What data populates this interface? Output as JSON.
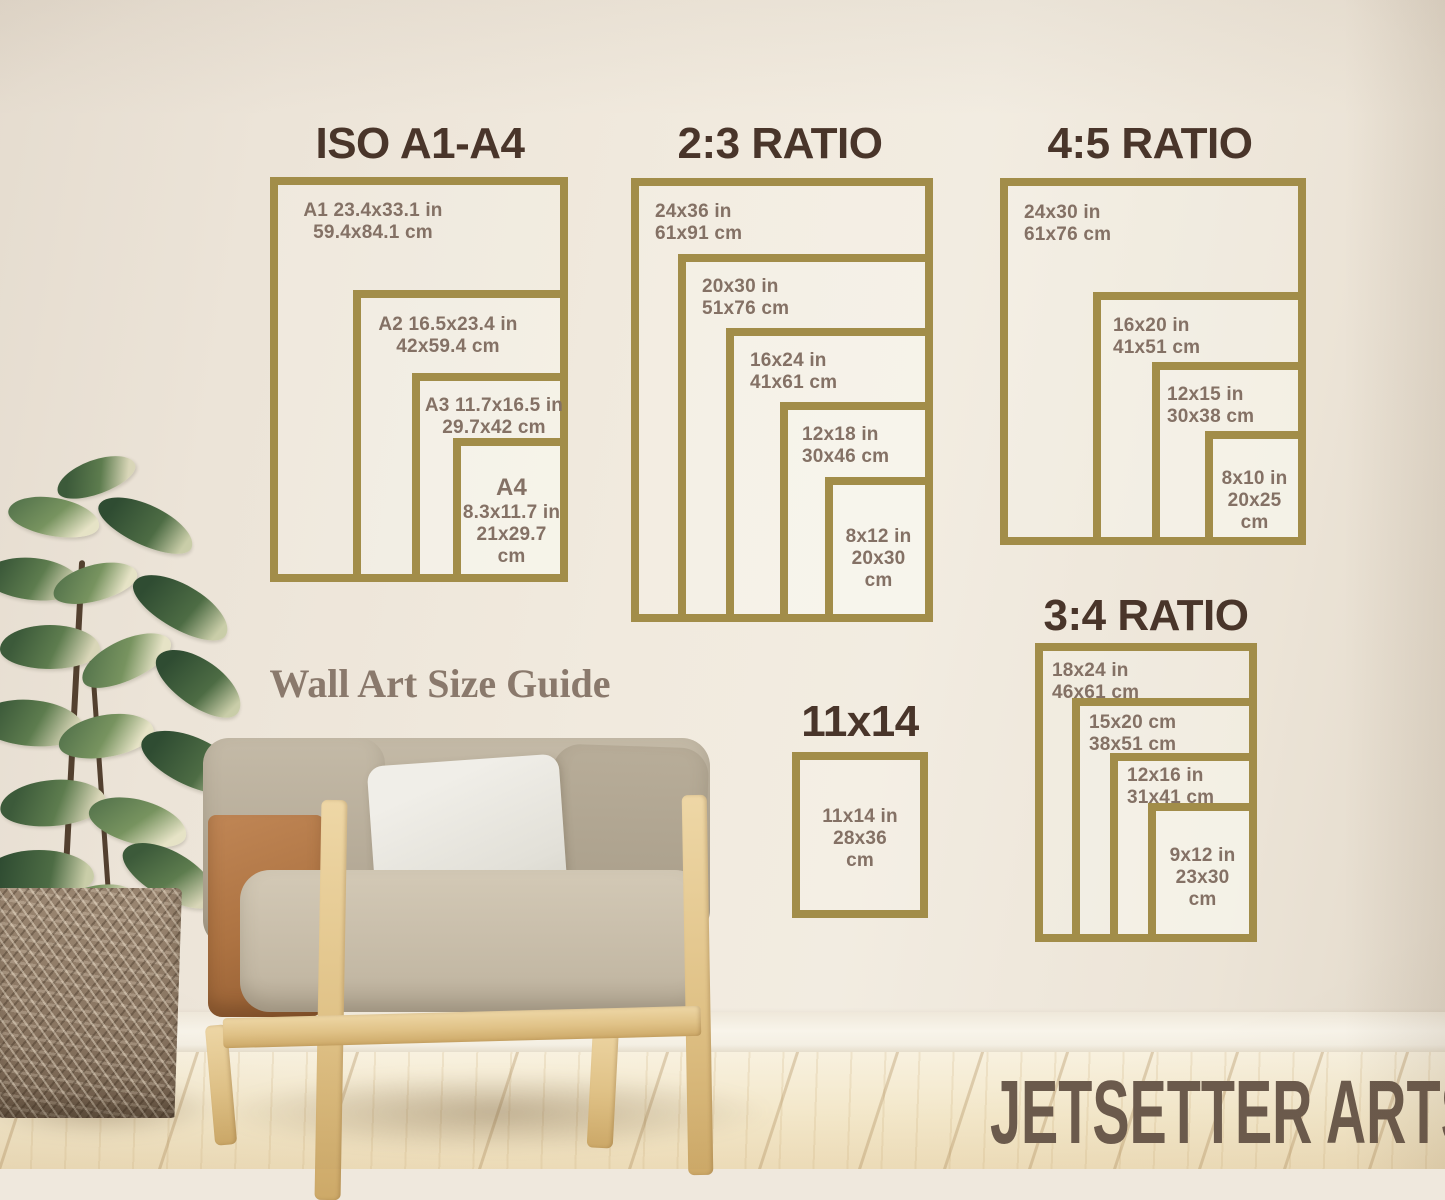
{
  "caption": "Wall Art Size Guide",
  "brand": "JETSETTER ARTS",
  "colors": {
    "frame_gold": "#a28d49",
    "title_brown": "#49352a",
    "label_brown": "#847165",
    "brand_taupe": "#6b5a4c"
  },
  "sections": [
    {
      "title": "ISO A1-A4",
      "frames": [
        {
          "name": "A1",
          "lines": [
            "A1 23.4x33.1 in",
            "59.4x84.1 cm"
          ]
        },
        {
          "name": "A2",
          "lines": [
            "A2 16.5x23.4 in",
            "42x59.4 cm"
          ]
        },
        {
          "name": "A3",
          "lines": [
            "A3 11.7x16.5 in",
            "29.7x42 cm"
          ]
        },
        {
          "name": "A4",
          "lines": [
            "A4",
            "8.3x11.7 in",
            "21x29.7",
            "cm"
          ]
        }
      ]
    },
    {
      "title": "2:3 RATIO",
      "frames": [
        {
          "name": "24x36",
          "lines": [
            "24x36 in",
            "61x91 cm"
          ]
        },
        {
          "name": "20x30",
          "lines": [
            "20x30 in",
            "51x76 cm"
          ]
        },
        {
          "name": "16x24",
          "lines": [
            "16x24 in",
            "41x61 cm"
          ]
        },
        {
          "name": "12x18",
          "lines": [
            "12x18 in",
            "30x46 cm"
          ]
        },
        {
          "name": "8x12",
          "lines": [
            "8x12 in",
            "20x30",
            "cm"
          ]
        }
      ]
    },
    {
      "title": "4:5 RATIO",
      "frames": [
        {
          "name": "24x30",
          "lines": [
            "24x30 in",
            "61x76 cm"
          ]
        },
        {
          "name": "16x20",
          "lines": [
            "16x20 in",
            "41x51 cm"
          ]
        },
        {
          "name": "12x15",
          "lines": [
            "12x15 in",
            "30x38 cm"
          ]
        },
        {
          "name": "8x10",
          "lines": [
            "8x10 in",
            "20x25",
            "cm"
          ]
        }
      ]
    },
    {
      "title": "3:4 RATIO",
      "frames": [
        {
          "name": "18x24",
          "lines": [
            "18x24 in",
            "46x61 cm"
          ]
        },
        {
          "name": "15x20",
          "lines": [
            "15x20 cm",
            "38x51 cm"
          ]
        },
        {
          "name": "12x16",
          "lines": [
            "12x16 in",
            "31x41 cm"
          ]
        },
        {
          "name": "9x12",
          "lines": [
            "9x12 in",
            "23x30",
            "cm"
          ]
        }
      ]
    },
    {
      "title": "11x14",
      "frames": [
        {
          "name": "11x14",
          "lines": [
            "11x14 in",
            "28x36",
            "cm"
          ]
        }
      ]
    }
  ]
}
